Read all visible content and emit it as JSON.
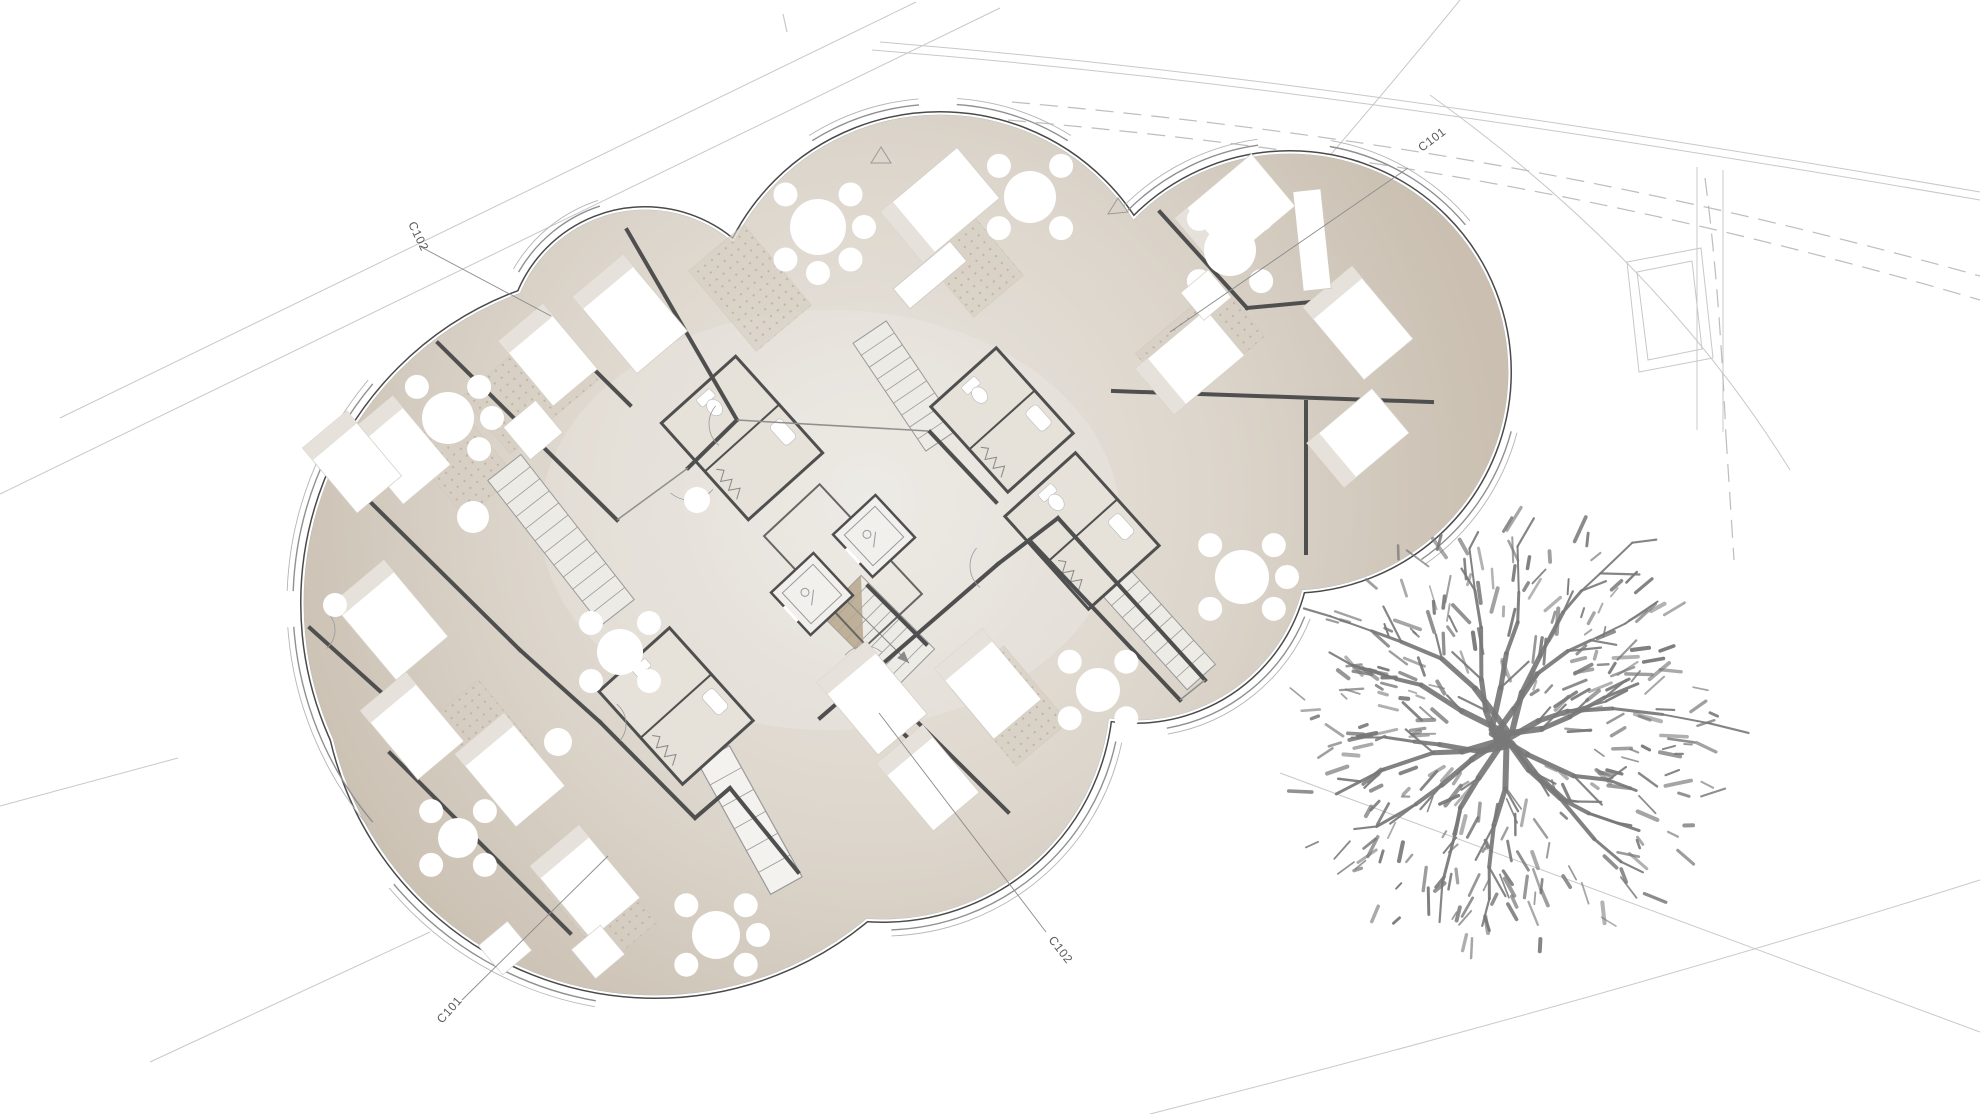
{
  "canvas": {
    "w": 1980,
    "h": 1114,
    "bg": "#ffffff"
  },
  "colors": {
    "floor_center": "#eae7e1",
    "floor_mid": "#dcd5cb",
    "floor_edge": "#cfc6b9",
    "floor_rim": "#cabfb0",
    "outline_dark": "#4a4a4a",
    "outline_white": "#ffffff",
    "outline_mid": "#b5b5b5",
    "wall": "#4f4f4f",
    "wall_light": "#8f8f8f",
    "furniture": "#ffffff",
    "furniture_shade": "#e6e2db",
    "rug_base": "#d7cfc3",
    "rug_dot": "#b9ae9e",
    "stair_line": "#9a9a9a",
    "stair_wedge": "#b6a68c",
    "tree": "#787878",
    "site_line": "#c8c8c8",
    "site_dash": "#bdbdbd",
    "label": "#5a5a5a",
    "band": "#909090"
  },
  "section_markers": [
    {
      "label": "C102",
      "x": 408,
      "y": 224,
      "rot": 64,
      "leader": [
        421,
        247,
        551,
        316
      ]
    },
    {
      "label": "C101",
      "x": 1422,
      "y": 152,
      "rot": -37,
      "leader": [
        1408,
        168,
        1170,
        332
      ]
    },
    {
      "label": "C101",
      "x": 442,
      "y": 1024,
      "rot": -48,
      "leader": [
        462,
        1000,
        608,
        856
      ]
    },
    {
      "label": "C102",
      "x": 1048,
      "y": 940,
      "rot": 52,
      "leader": [
        1046,
        932,
        879,
        713
      ]
    }
  ],
  "markers": {
    "triangles": [
      [
        881,
        147,
        871,
        163,
        891,
        163
      ],
      [
        1118,
        198,
        1108,
        214,
        1128,
        212
      ]
    ],
    "tick": [
      783,
      14,
      787,
      32
    ]
  },
  "site": {
    "solid": [
      "M60,418 L916,2",
      "M0,494 L1000,8",
      "M0,806 L178,758",
      "M150,1062 L430,932",
      "M1280,773 L1980,1032",
      "M1150,1114 Q1600,1000 1980,880",
      "M880,42 C1100,60 1400,92 1980,192",
      "M872,50 C1100,68 1400,100 1980,200",
      "M1460,0 Q1330,160 1150,360",
      "M1430,95 Q1660,260 1790,470",
      "M1697,167 L1697,430",
      "M1723,170 L1723,432"
    ],
    "dashed": [
      "M1012,102 C1300,128 1600,170 1980,276",
      "M1008,120 C1300,146 1600,188 1980,300",
      "M1705,178 C1716,260 1722,350 1726,436",
      "M1726,436 L1734,560"
    ],
    "rects": [
      "M1627,262 L1701,248 L1713,358 L1639,372 Z",
      "M1637,272 L1692,261 L1702,349 L1648,360 Z"
    ]
  },
  "building": {
    "lobes": [
      [
        645,
        345,
        135
      ],
      [
        940,
        345,
        230
      ],
      [
        1290,
        372,
        218
      ],
      [
        1135,
        548,
        172
      ],
      [
        883,
        692,
        227
      ],
      [
        655,
        665,
        330
      ],
      [
        634,
        603,
        330
      ]
    ],
    "outer_bands": [
      [
        0,
        -150,
        -108
      ],
      [
        1,
        -122,
        -95
      ],
      [
        1,
        -86,
        -58
      ],
      [
        2,
        -135,
        -98
      ],
      [
        2,
        -80,
        -40
      ],
      [
        2,
        15,
        55
      ],
      [
        3,
        22,
        80
      ],
      [
        4,
        12,
        88
      ],
      [
        5,
        100,
        140
      ],
      [
        6,
        -178,
        -140
      ],
      [
        6,
        140,
        176
      ]
    ],
    "walls_main": [
      [
        627,
        230,
        737,
        420
      ],
      [
        737,
        420,
        688,
        468
      ],
      [
        438,
        343,
        617,
        520
      ],
      [
        536,
        312,
        630,
        405
      ],
      [
        340,
        472,
        520,
        650
      ],
      [
        520,
        650,
        600,
        722
      ],
      [
        600,
        722,
        695,
        818
      ],
      [
        695,
        818,
        730,
        788
      ],
      [
        730,
        788,
        798,
        872
      ],
      [
        390,
        753,
        570,
        933
      ],
      [
        310,
        628,
        392,
        702
      ],
      [
        820,
        718,
        998,
        564
      ],
      [
        865,
        670,
        1008,
        812
      ],
      [
        905,
        735,
        963,
        790
      ],
      [
        998,
        564,
        1058,
        518
      ],
      [
        1058,
        518,
        1205,
        680
      ],
      [
        1032,
        543,
        1180,
        700
      ],
      [
        1306,
        402,
        1306,
        553
      ],
      [
        1113,
        391,
        1432,
        402
      ],
      [
        1160,
        212,
        1247,
        308
      ],
      [
        1247,
        308,
        1332,
        300
      ],
      [
        930,
        432,
        996,
        502
      ],
      [
        868,
        586,
        926,
        644
      ]
    ],
    "walls_light": [
      [
        688,
        468,
        617,
        520
      ],
      [
        737,
        420,
        928,
        431
      ],
      [
        1180,
        700,
        1205,
        680
      ]
    ],
    "core_box": [
      843,
      565,
      150,
      76,
      47
    ],
    "stairs": [
      {
        "cx": 878,
        "cy": 632,
        "len": 104,
        "wid": 56,
        "rot": 45,
        "treads": 9,
        "wedge": true
      },
      {
        "cx": 561,
        "cy": 540,
        "len": 184,
        "wid": 42,
        "rot": 52,
        "treads": 12,
        "wedge": false
      },
      {
        "cx": 906,
        "cy": 386,
        "len": 130,
        "wid": 40,
        "rot": 56,
        "treads": 9,
        "wedge": false
      },
      {
        "cx": 1131,
        "cy": 599,
        "len": 210,
        "wid": 38,
        "rot": 48,
        "treads": 13,
        "wedge": false
      }
    ],
    "elevators": [
      [
        812,
        594,
        58,
        47
      ],
      [
        874,
        536,
        58,
        47
      ]
    ],
    "bath_pods": [
      [
        742,
        438,
        130,
        100,
        48
      ],
      [
        1082,
        531,
        125,
        95,
        48
      ],
      [
        676,
        706,
        125,
        95,
        48
      ],
      [
        1002,
        420,
        115,
        88,
        48
      ]
    ],
    "beds": [
      [
        630,
        314,
        100,
        66,
        50
      ],
      [
        548,
        355,
        85,
        58,
        50
      ],
      [
        398,
        450,
        90,
        62,
        50
      ],
      [
        352,
        462,
        85,
        58,
        50
      ],
      [
        390,
        620,
        100,
        68,
        50
      ],
      [
        412,
        726,
        90,
        60,
        50
      ],
      [
        510,
        770,
        95,
        64,
        50
      ],
      [
        585,
        882,
        95,
        64,
        50
      ],
      [
        872,
        698,
        95,
        64,
        50
      ],
      [
        928,
        778,
        88,
        60,
        50
      ],
      [
        988,
        684,
        92,
        62,
        50
      ],
      [
        940,
        205,
        100,
        66,
        -40
      ],
      [
        1235,
        212,
        100,
        68,
        -40
      ],
      [
        1358,
        323,
        95,
        64,
        50
      ],
      [
        1190,
        362,
        92,
        60,
        -40
      ],
      [
        1358,
        438,
        85,
        58,
        -40
      ]
    ],
    "tables": [
      [
        448,
        418,
        26,
        5
      ],
      [
        818,
        227,
        28,
        6
      ],
      [
        1030,
        197,
        26,
        4
      ],
      [
        1230,
        250,
        26,
        4
      ],
      [
        1242,
        577,
        27,
        5
      ],
      [
        1098,
        690,
        22,
        4
      ],
      [
        620,
        652,
        23,
        4
      ],
      [
        716,
        935,
        24,
        5
      ],
      [
        458,
        838,
        20,
        4
      ]
    ],
    "singles": [
      [
        473,
        517,
        16
      ],
      [
        335,
        605,
        12
      ],
      [
        697,
        500,
        13
      ],
      [
        558,
        742,
        14
      ]
    ],
    "rugs": [
      [
        530,
        388,
        115,
        75,
        -40
      ],
      [
        750,
        288,
        105,
        72,
        50
      ],
      [
        968,
        260,
        95,
        65,
        50
      ],
      [
        1200,
        345,
        110,
        70,
        -40
      ],
      [
        1010,
        706,
        100,
        68,
        50
      ],
      [
        600,
        905,
        100,
        65,
        50
      ],
      [
        485,
        733,
        90,
        58,
        50
      ],
      [
        460,
        460,
        95,
        65,
        50
      ]
    ],
    "squares": [
      [
        533,
        430,
        42,
        50
      ],
      [
        505,
        948,
        38,
        50
      ],
      [
        598,
        952,
        38,
        50
      ],
      [
        1206,
        295,
        36,
        -40
      ]
    ],
    "dressers": [
      [
        930,
        275,
        74,
        26,
        -40
      ],
      [
        1312,
        240,
        28,
        100,
        -6
      ]
    ],
    "window_band": [
      750,
      820,
      150,
      36,
      61,
      5
    ],
    "door_arcs": [
      [
        690,
        470,
        30,
        40,
        130
      ],
      [
        737,
        424,
        28,
        130,
        220
      ],
      [
        600,
        724,
        26,
        -50,
        40
      ],
      [
        998,
        566,
        28,
        130,
        220
      ],
      [
        865,
        672,
        26,
        -140,
        -50
      ],
      [
        311,
        630,
        24,
        -40,
        50
      ]
    ]
  },
  "tree": {
    "cx": 1502,
    "cy": 738,
    "r": 205,
    "seed": 11,
    "rays": 16,
    "twigs": 300
  }
}
